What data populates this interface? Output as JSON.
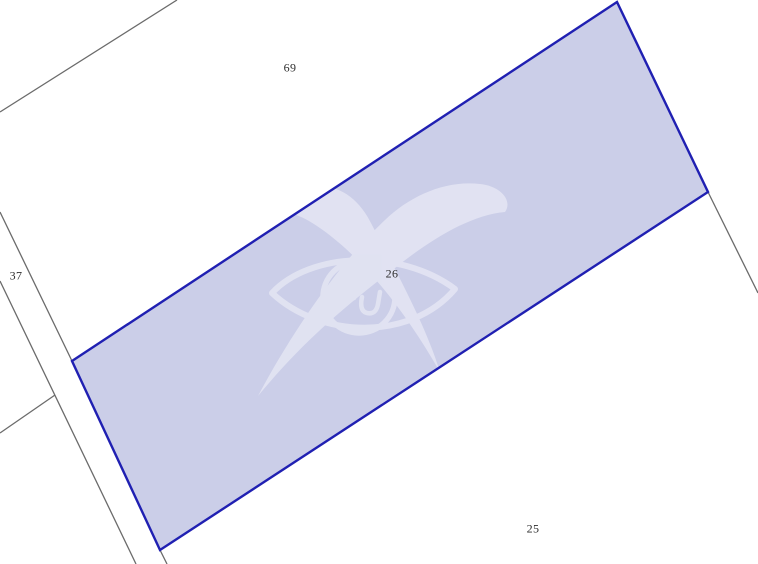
{
  "map": {
    "type": "cadastral-parcel-map",
    "selected_parcel_number": "26",
    "labels": [
      {
        "text": "69"
      },
      {
        "text": "37"
      },
      {
        "text": "26"
      },
      {
        "text": "25"
      }
    ],
    "watermark": "agency-logo-watermark"
  },
  "geometry": {
    "selected_parcel_points": "72,361 617,2 708,192 160,550",
    "boundary_lines": [
      "0,112 177,0",
      "0,212 72,361",
      "0,281 136,564",
      "55,395 0,433",
      "708,192 758,293",
      "160,550 167,564"
    ]
  },
  "colors": {
    "background": "#ffffff",
    "parcel_fill": "#cbcee8",
    "parcel_border": "#2020b2",
    "boundary_line": "#6b6b6b",
    "label_text": "#2e2e2e",
    "watermark": "#ffffff"
  }
}
